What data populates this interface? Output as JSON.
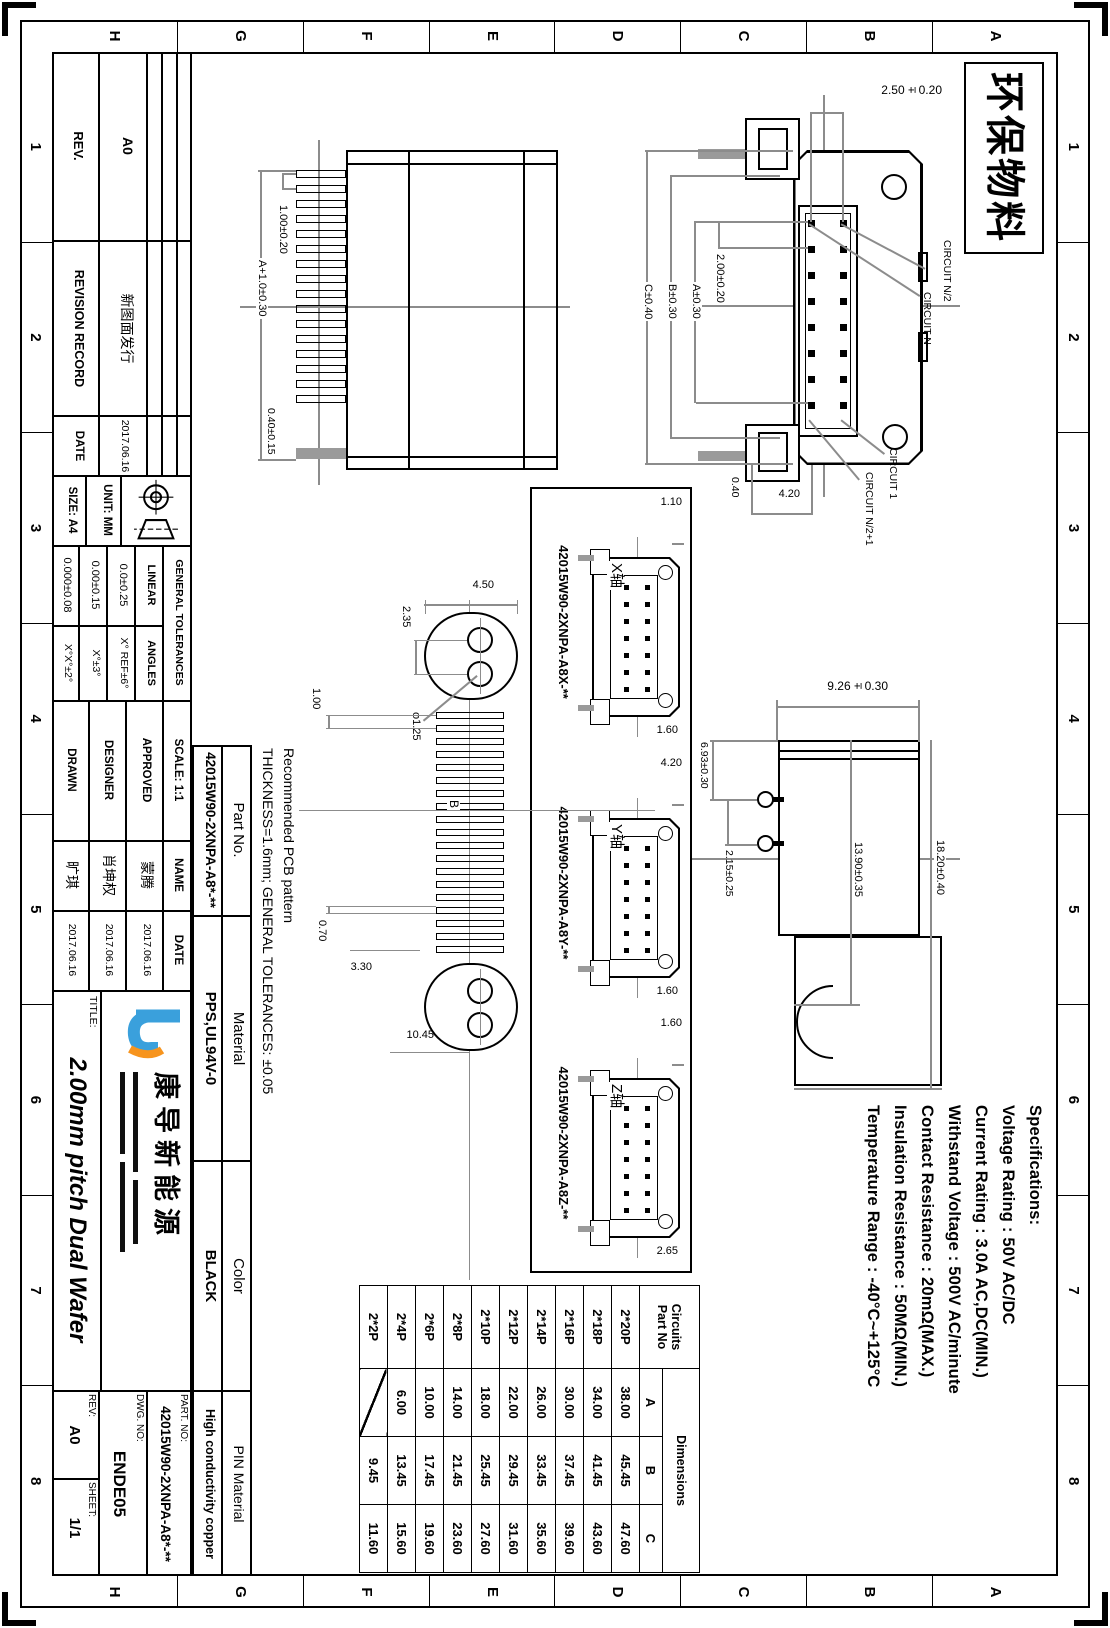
{
  "border": {
    "numbers": [
      "1",
      "2",
      "3",
      "4",
      "5",
      "6",
      "7",
      "8"
    ],
    "letters": [
      "A",
      "B",
      "C",
      "D",
      "E",
      "F",
      "G",
      "H"
    ],
    "eco_label": "环保物料"
  },
  "specs": {
    "title": "Specifications:",
    "lines": [
      "Voltage Rating : 50V AC/DC",
      "Current Rating : 3.0A AC,DC(MIN.)",
      "Withstand Voltage : 500V AC/minute",
      "Contact Resistance : 20mΩ(MAX.)",
      "Insulation Resistance : 50MΩ(MIN.)",
      "Temperature Range : -40°C~+125°C"
    ]
  },
  "front_view": {
    "dims": {
      "row_pitch": "2.50±0.20",
      "col_pitch": "2.00±0.20",
      "span_a": "A±0.30",
      "span_b": "B±0.30",
      "span_c": "C±0.40",
      "d420": "4.20",
      "d040": "0.40"
    },
    "labels": {
      "circuit_n2": "CIRCUIT N/2",
      "circuit_n": "CIRCUIT N",
      "circuit_1": "CIRCUIT 1",
      "circuit_n21": "CIRCUIT N/2+1"
    }
  },
  "top_view": {
    "dims": {
      "pitch": "1.00±0.20",
      "span": "A+1.0±0.30",
      "pin_w": "0.40±0.15"
    }
  },
  "side_view": {
    "dims": {
      "height": "9.26±0.30",
      "d693": "6.93±0.30",
      "d215": "2.15±0.25",
      "d1390": "13.90±0.35",
      "d1820": "18.20±0.40"
    }
  },
  "axis_views": {
    "x": {
      "part_no": "42015W90-2XNPA-A8X-**",
      "axis": "X轴",
      "dim_left": "1.10",
      "dim_right": "1.60"
    },
    "y": {
      "part_no": "42015W90-2XNPA-A8Y-**",
      "axis": "Y轴",
      "dim_left": "4.20",
      "dim_right": "1.60"
    },
    "z": {
      "part_no": "42015W90-2XNPA-A8Z-**",
      "axis": "Z轴",
      "dim_left": "1.60",
      "dim_right": "2.65"
    }
  },
  "pcb": {
    "note1": "Recommended PCB pattern",
    "note2": "THICKNESS=1.6mm; GENERAL TOLERANCES: ±0.05",
    "dims": {
      "oval_w": "4.50",
      "hole_pitch": "2.35",
      "hole_dia": "φ1.25",
      "pad_pitch": "1.00",
      "pad_w": "0.70",
      "pad_len": "3.30",
      "d1045": "10.45",
      "center": "B"
    }
  },
  "circuits_table": {
    "h_line1": "Circuits",
    "h_line2": "Part No",
    "span_header": "Dimensions",
    "cols": [
      "A",
      "B",
      "C"
    ],
    "rows": [
      {
        "p": "2*20P",
        "a": "38.00",
        "b": "45.45",
        "c": "47.60"
      },
      {
        "p": "2*18P",
        "a": "34.00",
        "b": "41.45",
        "c": "43.60"
      },
      {
        "p": "2*16P",
        "a": "30.00",
        "b": "37.45",
        "c": "39.60"
      },
      {
        "p": "2*14P",
        "a": "26.00",
        "b": "33.45",
        "c": "35.60"
      },
      {
        "p": "2*12P",
        "a": "22.00",
        "b": "29.45",
        "c": "31.60"
      },
      {
        "p": "2*10P",
        "a": "18.00",
        "b": "25.45",
        "c": "27.60"
      },
      {
        "p": "2*8P",
        "a": "14.00",
        "b": "21.45",
        "c": "23.60"
      },
      {
        "p": "2*6P",
        "a": "10.00",
        "b": "17.45",
        "c": "19.60"
      },
      {
        "p": "2*4P",
        "a": "6.00",
        "b": "13.45",
        "c": "15.60"
      },
      {
        "p": "2*2P",
        "a": "",
        "b": "9.45",
        "c": "11.60"
      }
    ]
  },
  "title_block": {
    "revision": {
      "rev_h": "REV.",
      "record_h": "REVISION RECORD",
      "date_h": "DATE",
      "rev": "A0",
      "record": "新图面发行",
      "date": "2017.06.16"
    },
    "unit_label": "UNIT:",
    "unit": "MM",
    "size_label": "SIZE:",
    "size": "A4",
    "tol": {
      "title": "GENERAL TOLERANCES",
      "linear": "LINEAR",
      "angles": "ANGLES",
      "linear_vals": [
        "0.0±0.25",
        "0.00±0.15",
        "0.000±0.08"
      ],
      "angle_vals": [
        "X° REF±6°",
        "X°±3°",
        "X°X°±2°"
      ]
    },
    "approval": {
      "scale_label": "SCALE:",
      "scale": "1:1",
      "name_h": "NAME",
      "date_h": "DATE",
      "rows": [
        {
          "role": "APPROVED",
          "name": "蒙腾",
          "date": "2017.06.16"
        },
        {
          "role": "DESIGNER",
          "name": "肖坤权",
          "date": "2017.06.16"
        },
        {
          "role": "DRAWN",
          "name": "旷琪",
          "date": "2017.06.16"
        }
      ]
    },
    "company": "康导新能源",
    "title_label": "TITLE:",
    "title": "2.00mm pitch Dual Wafer",
    "part_no_label": "PART. NO:",
    "part_no": "42015W90-2XNPA-A8*-**",
    "dwg_label": "DWG. NO:",
    "dwg_no": "ENDE05",
    "rev_label": "REV:",
    "rev": "A0",
    "sheet_label": "SHEET:",
    "sheet": "1/1",
    "props": {
      "headers": [
        "Part No.",
        "Material",
        "Color",
        "PIN Material"
      ],
      "values": [
        "42015W90-2XNPA-A8*-**",
        "PPS,UL94V-0",
        "BLACK",
        "High conductivity copper"
      ]
    }
  }
}
